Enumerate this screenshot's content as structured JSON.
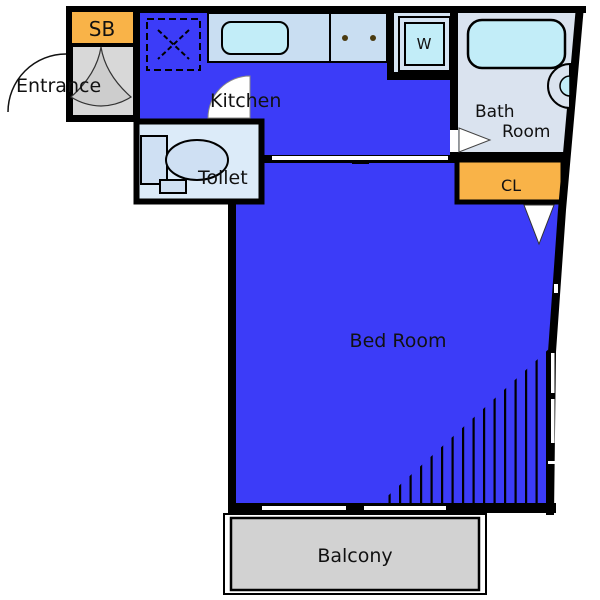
{
  "floor_plan": {
    "labels": {
      "sb": "SB",
      "entrance": "Entrance",
      "kitchen": "Kitchen",
      "toilet": "Toilet",
      "washer": "W",
      "bath_line1": "Bath",
      "bath_line2": "Room",
      "closet": "CL",
      "bedroom": "Bed Room",
      "balcony": "Balcony"
    },
    "colors": {
      "room_blue": "#3c3cf8",
      "accent_orange": "#f9b348",
      "fixture_cyan": "#c2edf8",
      "counter_light_blue": "#c9def2",
      "toilet_light_blue": "#dcebf9",
      "bathroom_light_blue": "#dae3ef",
      "entrance_gray": "#d8d8d8",
      "balcony_gray": "#d2d2d2",
      "wall": "#000000"
    }
  }
}
